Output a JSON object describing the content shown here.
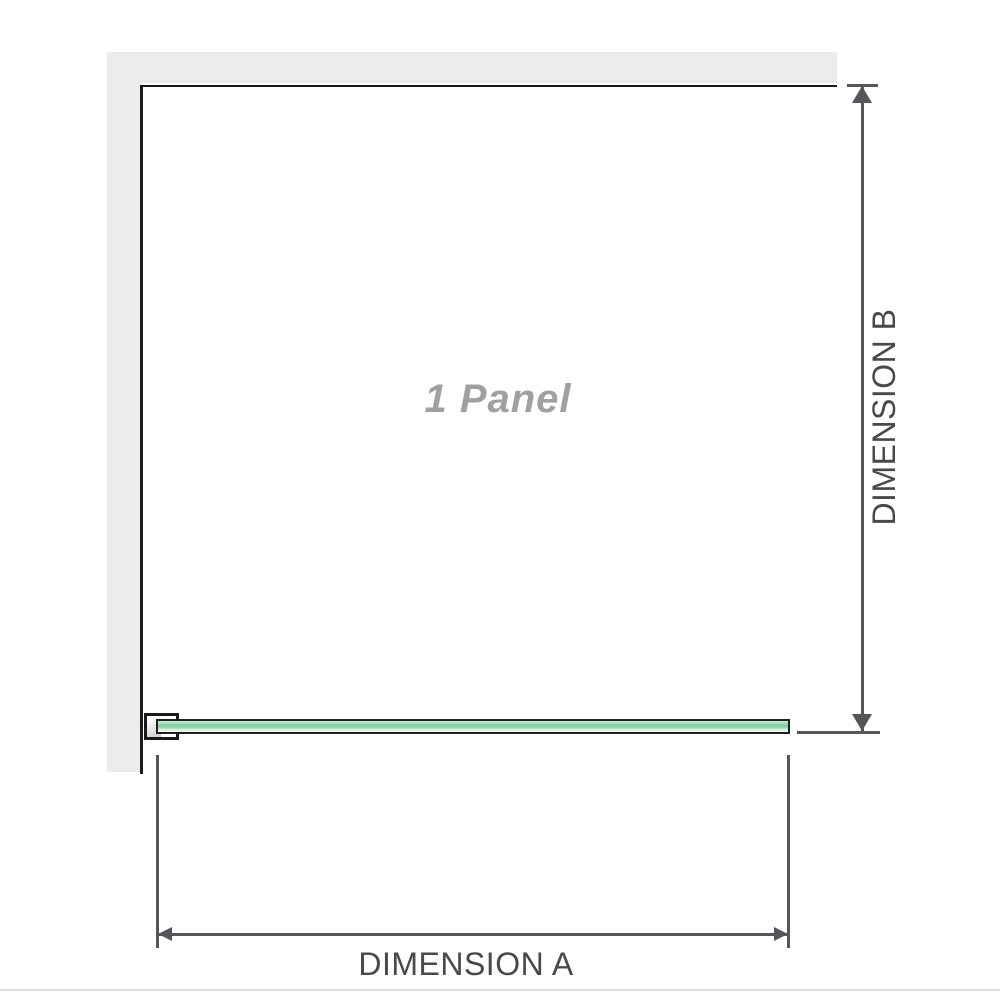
{
  "root_style": "--wall:#ececec;--frame:#1a1a1a;--dim:#55565a;--dimtext:#47494b;--paneltext:#a0a0a0;--glassborder:#202020;--g1:#c6ead3;--g2:#b4e2c5;--g3:#7fce9d;--g4:#93d6ab;--g5:#dcf2e3;--g6:#eff9f3;--bracketg:#c9c9c9;--divider:#dcdcd7",
  "diagram": {
    "panel_label": "1 Panel",
    "dimension_a_label": "DIMENSION A",
    "dimension_b_label": "DIMENSION B",
    "colors": {
      "wall": "#ececec",
      "frame_line": "#1a1a1a",
      "dimension_line": "#55565a",
      "dimension_text": "#47494b",
      "panel_watermark_text": "#a0a0a0",
      "glass_border": "#202020",
      "glass_green_light": "#c6ead3",
      "glass_green_mid": "#7fce9d",
      "glass_green_pale": "#eff9f3",
      "bracket_fill": "#c9c9c9",
      "bottom_divider": "#dcdcd7"
    }
  }
}
